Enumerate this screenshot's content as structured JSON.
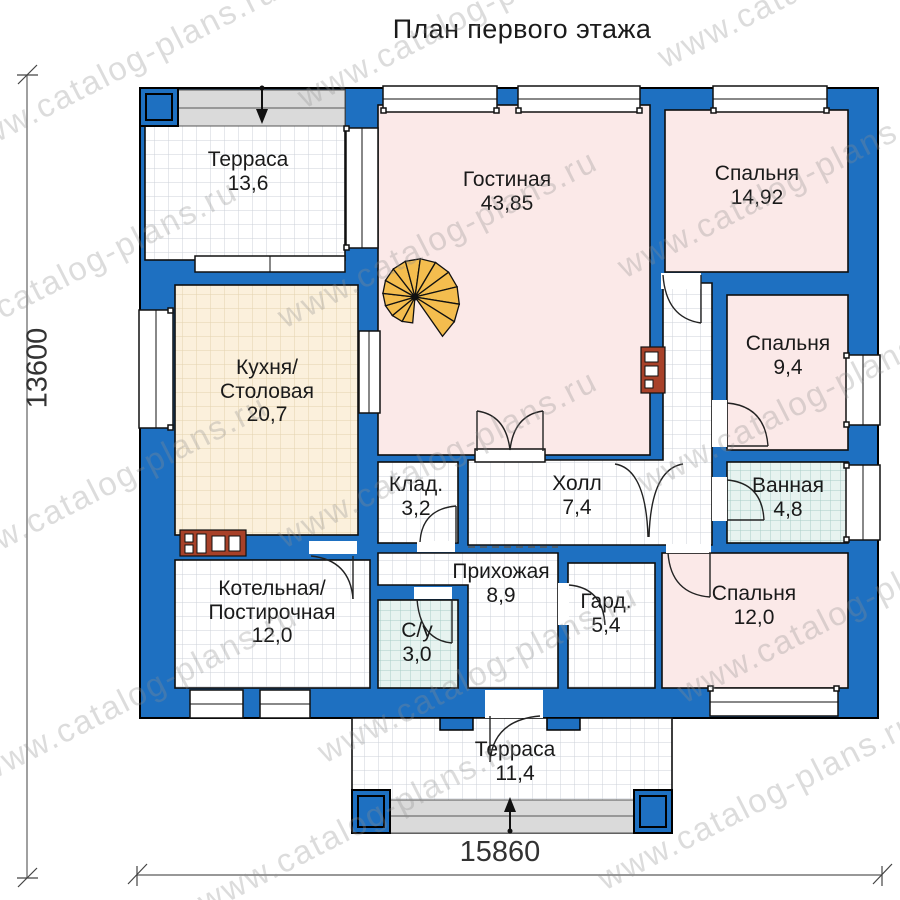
{
  "title": "План первого этажа",
  "watermark": {
    "text": "www.catalog-plans.ru"
  },
  "dimensions": {
    "height_label": "13600",
    "width_label": "15860"
  },
  "rooms": [
    {
      "id": "terrace-top",
      "name": "Терраса",
      "area": "13,6"
    },
    {
      "id": "living-room",
      "name": "Гостиная",
      "area": "43,85"
    },
    {
      "id": "bedroom-1",
      "name": "Спальня",
      "area": "14,92"
    },
    {
      "id": "kitchen-dining",
      "name": "Кухня/Столовая",
      "area": "20,7"
    },
    {
      "id": "bedroom-2",
      "name": "Спальня",
      "area": "9,4"
    },
    {
      "id": "pantry",
      "name": "Клад.",
      "area": "3,2"
    },
    {
      "id": "hall",
      "name": "Холл",
      "area": "7,4"
    },
    {
      "id": "bathroom",
      "name": "Ванная",
      "area": "4,8"
    },
    {
      "id": "boiler-laundry",
      "name": "Котельная/Постирочная",
      "area": "12,0"
    },
    {
      "id": "entrance-hall",
      "name": "Прихожая",
      "area": "8,9"
    },
    {
      "id": "wc",
      "name": "С/у",
      "area": "3,0"
    },
    {
      "id": "wardrobe",
      "name": "Гард.",
      "area": "5,4"
    },
    {
      "id": "bedroom-3",
      "name": "Спальня",
      "area": "12,0"
    },
    {
      "id": "terrace-bottom",
      "name": "Терраса",
      "area": "11,4"
    }
  ],
  "colors": {
    "wall_blue": "#1e70c1",
    "room_pink": "#fbe9e8",
    "kitchen_beige": "#fbf0dc",
    "wet_room_blue": "#e7f3f0",
    "stair_orange": "#f4bd4e",
    "brick_red": "#a84129",
    "step_gray": "#dadada"
  }
}
